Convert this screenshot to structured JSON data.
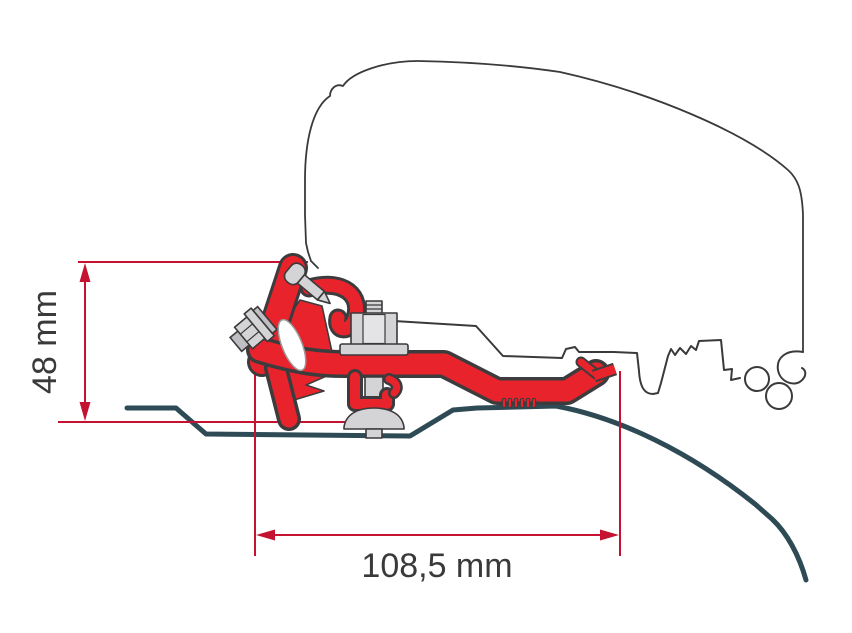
{
  "diagram": {
    "kind": "technical cross-section drawing",
    "subject": "roof awning bracket adapter mounted on van roof profile",
    "dimension_height": {
      "label": "48 mm",
      "orientation": "vertical"
    },
    "dimension_width": {
      "label": "108,5 mm",
      "orientation": "horizontal"
    },
    "colors": {
      "dimension_red": "#c41230",
      "bracket_red": "#e8232b",
      "outline_gray": "#3a3a3c",
      "roof_teal": "#2e4b55",
      "metal_gray": "#d4d4d6",
      "background": "#ffffff"
    },
    "parts": [
      "van-body-outline",
      "awning-rail-profile",
      "adapter-bracket",
      "hex-bolt",
      "fixing-screw",
      "clamp-bolt-assembly",
      "roof-sheet-line"
    ]
  }
}
